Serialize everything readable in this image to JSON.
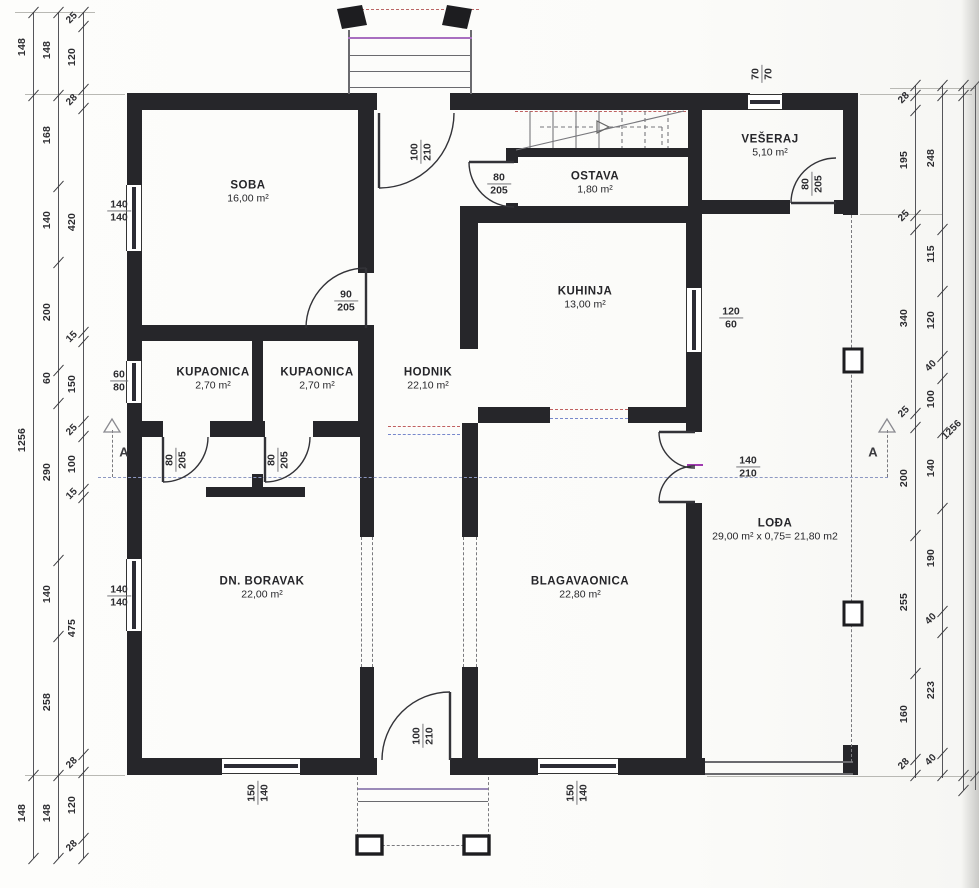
{
  "rooms": [
    {
      "name": "SOBA",
      "area": "16,00 m²",
      "x": 248,
      "y": 192
    },
    {
      "name": "OSTAVA",
      "area": "1,80 m²",
      "x": 595,
      "y": 183
    },
    {
      "name": "VEŠERAJ",
      "area": "5,10 m²",
      "x": 770,
      "y": 146
    },
    {
      "name": "KUHINJA",
      "area": "13,00 m²",
      "x": 585,
      "y": 298
    },
    {
      "name": "KUPAONICA",
      "area": "2,70 m²",
      "x": 213,
      "y": 379
    },
    {
      "name": "KUPAONICA",
      "area": "2,70 m²",
      "x": 317,
      "y": 379
    },
    {
      "name": "HODNIK",
      "area": "22,10 m²",
      "x": 428,
      "y": 379
    },
    {
      "name": "DN. BORAVAK",
      "area": "22,00 m²",
      "x": 262,
      "y": 588
    },
    {
      "name": "BLAGAVAONICA",
      "area": "22,80 m²",
      "x": 580,
      "y": 588
    },
    {
      "name": "LOĐA",
      "area": "29,00 m² x 0,75= 21,80 m2",
      "x": 775,
      "y": 530
    }
  ],
  "openings": [
    {
      "w": "100",
      "h": "210",
      "x": 421,
      "y": 152,
      "rot": true
    },
    {
      "w": "80",
      "h": "205",
      "x": 499,
      "y": 184,
      "rot": false
    },
    {
      "w": "70",
      "h": "70",
      "x": 762,
      "y": 74,
      "rot": true
    },
    {
      "w": "80",
      "h": "205",
      "x": 812,
      "y": 184,
      "rot": true
    },
    {
      "w": "90",
      "h": "205",
      "x": 346,
      "y": 301,
      "rot": false
    },
    {
      "w": "140",
      "h": "140",
      "x": 119,
      "y": 211,
      "rot": false
    },
    {
      "w": "60",
      "h": "80",
      "x": 119,
      "y": 381,
      "rot": false
    },
    {
      "w": "80",
      "h": "205",
      "x": 176,
      "y": 460,
      "rot": true
    },
    {
      "w": "80",
      "h": "205",
      "x": 278,
      "y": 460,
      "rot": true
    },
    {
      "w": "120",
      "h": "60",
      "x": 731,
      "y": 318,
      "rot": false
    },
    {
      "w": "140",
      "h": "210",
      "x": 748,
      "y": 467,
      "rot": false
    },
    {
      "w": "140",
      "h": "140",
      "x": 119,
      "y": 596,
      "rot": false
    },
    {
      "w": "150",
      "h": "140",
      "x": 258,
      "y": 793,
      "rot": true
    },
    {
      "w": "100",
      "h": "210",
      "x": 423,
      "y": 736,
      "rot": true
    },
    {
      "w": "150",
      "h": "140",
      "x": 577,
      "y": 793,
      "rot": true
    }
  ],
  "section_markers": [
    {
      "label": "A",
      "x": 124,
      "y": 452
    },
    {
      "label": "A",
      "x": 873,
      "y": 452
    }
  ],
  "dimensions": {
    "left": [
      {
        "x": 33,
        "y1": 12,
        "y2": 858,
        "ticks": [
          12,
          95,
          775,
          858
        ],
        "labels": [
          {
            "t": "148",
            "y": 47
          },
          {
            "t": "1256",
            "y": 440
          },
          {
            "t": "148",
            "y": 813
          }
        ]
      },
      {
        "x": 58,
        "y1": 12,
        "y2": 858,
        "ticks": [
          12,
          95,
          186,
          262,
          370,
          403,
          560,
          636,
          775,
          858
        ],
        "labels": [
          {
            "t": "148",
            "y": 50
          },
          {
            "t": "168",
            "y": 135
          },
          {
            "t": "140",
            "y": 220
          },
          {
            "t": "200",
            "y": 312
          },
          {
            "t": "60",
            "y": 378
          },
          {
            "t": "290",
            "y": 472
          },
          {
            "t": "140",
            "y": 594
          },
          {
            "t": "258",
            "y": 702
          },
          {
            "t": "148",
            "y": 813
          }
        ]
      },
      {
        "x": 83,
        "y1": 12,
        "y2": 858,
        "ticks": [
          12,
          26,
          89,
          108,
          332,
          341,
          421,
          436,
          489,
          497,
          754,
          772,
          838,
          858
        ],
        "labels": [
          {
            "t": "25",
            "y": 18,
            "tilt": true
          },
          {
            "t": "120",
            "y": 57
          },
          {
            "t": "28",
            "y": 100,
            "tilt": true
          },
          {
            "t": "420",
            "y": 222
          },
          {
            "t": "15",
            "y": 337,
            "tilt": true
          },
          {
            "t": "150",
            "y": 384
          },
          {
            "t": "25",
            "y": 430,
            "tilt": true
          },
          {
            "t": "100",
            "y": 464
          },
          {
            "t": "15",
            "y": 494,
            "tilt": true
          },
          {
            "t": "475",
            "y": 628
          },
          {
            "t": "28",
            "y": 763,
            "tilt": true
          },
          {
            "t": "120",
            "y": 805
          },
          {
            "t": "28",
            "y": 846,
            "tilt": true
          }
        ]
      }
    ],
    "right": [
      {
        "x": 915,
        "y1": 85,
        "y2": 778,
        "ticks": [
          85,
          95,
          110,
          215,
          229,
          413,
          427,
          535,
          673,
          759,
          775
        ],
        "labels": [
          {
            "t": "28",
            "y": 98,
            "tilt": true
          },
          {
            "t": "195",
            "y": 160
          },
          {
            "t": "25",
            "y": 216,
            "tilt": true
          },
          {
            "t": "340",
            "y": 318
          },
          {
            "t": "25",
            "y": 412,
            "tilt": true
          },
          {
            "t": "200",
            "y": 478
          },
          {
            "t": "255",
            "y": 602
          },
          {
            "t": "160",
            "y": 714
          },
          {
            "t": "28",
            "y": 764,
            "tilt": true
          }
        ]
      },
      {
        "x": 942,
        "y1": 85,
        "y2": 778,
        "ticks": [
          85,
          95,
          229,
          291,
          356,
          378,
          432,
          508,
          611,
          632,
          753,
          775
        ],
        "labels": [
          {
            "t": "248",
            "y": 158
          },
          {
            "t": "115",
            "y": 254
          },
          {
            "t": "120",
            "y": 320
          },
          {
            "t": "40",
            "y": 366,
            "tilt": true
          },
          {
            "t": "100",
            "y": 399
          },
          {
            "t": "140",
            "y": 468
          },
          {
            "t": "190",
            "y": 558
          },
          {
            "t": "40",
            "y": 619,
            "tilt": true
          },
          {
            "t": "223",
            "y": 690
          },
          {
            "t": "40",
            "y": 760,
            "tilt": true
          }
        ]
      },
      {
        "x": 963,
        "y1": 85,
        "y2": 790,
        "ticks": [
          85,
          95,
          775,
          790
        ],
        "labels": [
          {
            "t": "1256",
            "y": 430,
            "tilt": true
          }
        ]
      },
      {
        "x": 975,
        "y1": 85,
        "y2": 790,
        "ticks": [
          85,
          775
        ],
        "labels": []
      }
    ]
  }
}
